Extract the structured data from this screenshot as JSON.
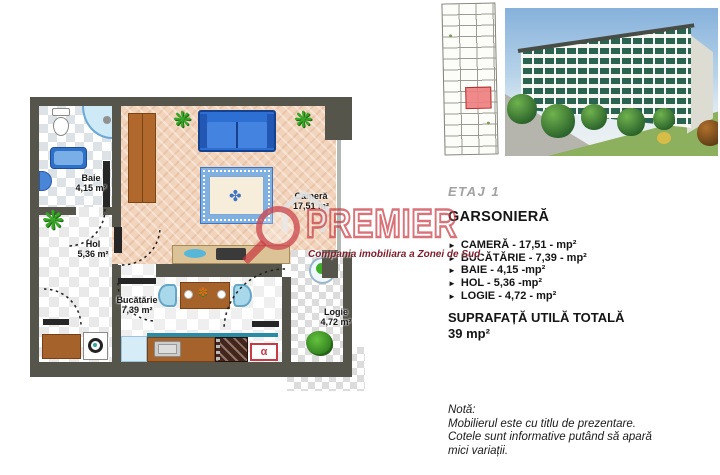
{
  "floorplan": {
    "rooms": [
      {
        "name": "Baie",
        "area": "4,15 m²"
      },
      {
        "name": "Hol",
        "area": "5,36 m²"
      },
      {
        "name": "Cameră",
        "area": "17,51 m²"
      },
      {
        "name": "Bucătărie",
        "area": "7,39 m²"
      },
      {
        "name": "Logie",
        "area": "4,72 m²"
      }
    ],
    "kitchen_symbol": "α",
    "icons": {
      "plant": "❋",
      "flower": "✽",
      "rug_ornament": "✤"
    }
  },
  "watermark": {
    "brand": "PREMIER",
    "tagline": "Compania imobiliara a Zonei de Sud"
  },
  "details": {
    "floor_label": "ETAJ 1",
    "title": "GARSONIERĂ",
    "bullet": "►",
    "items": [
      "CAMERĂ - 17,51 - mp²",
      "BUCĂTĂRIE - 7,39 - mp²",
      "BAIE - 4,15 -mp²",
      "HOL - 5,36 -mp²",
      "LOGIE - 4,72 - mp²"
    ],
    "total_label": "SUPRAFAȚĂ UTILĂ TOTALĂ",
    "total_value": "39 mp²",
    "note": {
      "title": "Notă:",
      "lines": [
        "Mobilierul este cu titlu de prezentare.",
        "Cotele sunt informative putând să apară",
        "mici variații."
      ]
    }
  },
  "colors": {
    "watermark_red": "#c5303a",
    "wall": "#56554b",
    "highlighted_unit": "#ee7d7d",
    "sofa_blue": "#2e6fd3",
    "furniture_brown": "#a5622a"
  }
}
